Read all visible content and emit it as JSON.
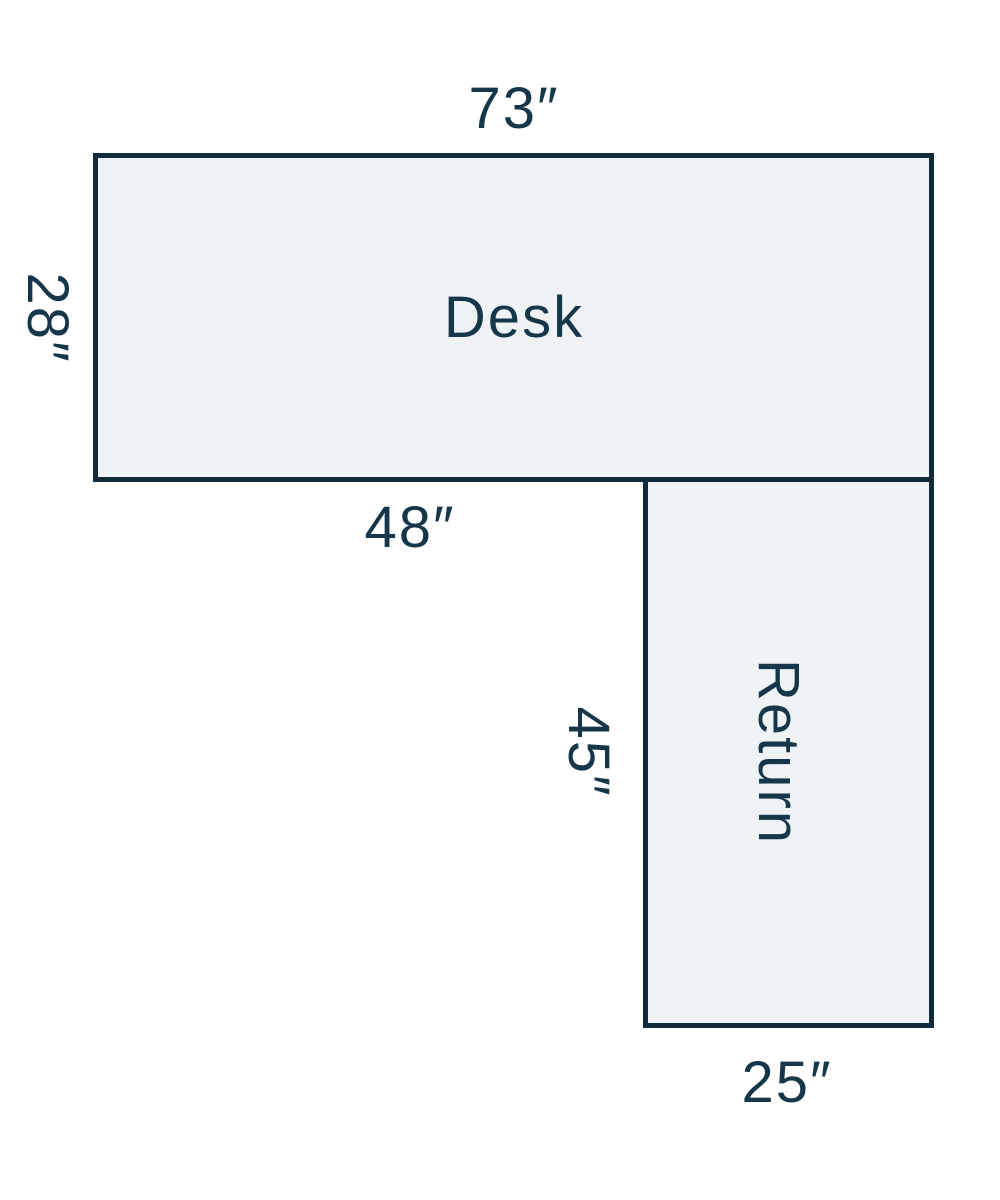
{
  "colors": {
    "canvas_bg": "#ffffff",
    "shape_fill": "#eff3f6",
    "shape_stroke": "#112b3c",
    "label_text": "#16374a"
  },
  "desk": {
    "label": "Desk",
    "top_dimension": "73″",
    "left_dimension": "28″",
    "bottom_dimension": "48″"
  },
  "return": {
    "label": "Return",
    "left_dimension": "45″",
    "bottom_dimension": "25″"
  }
}
